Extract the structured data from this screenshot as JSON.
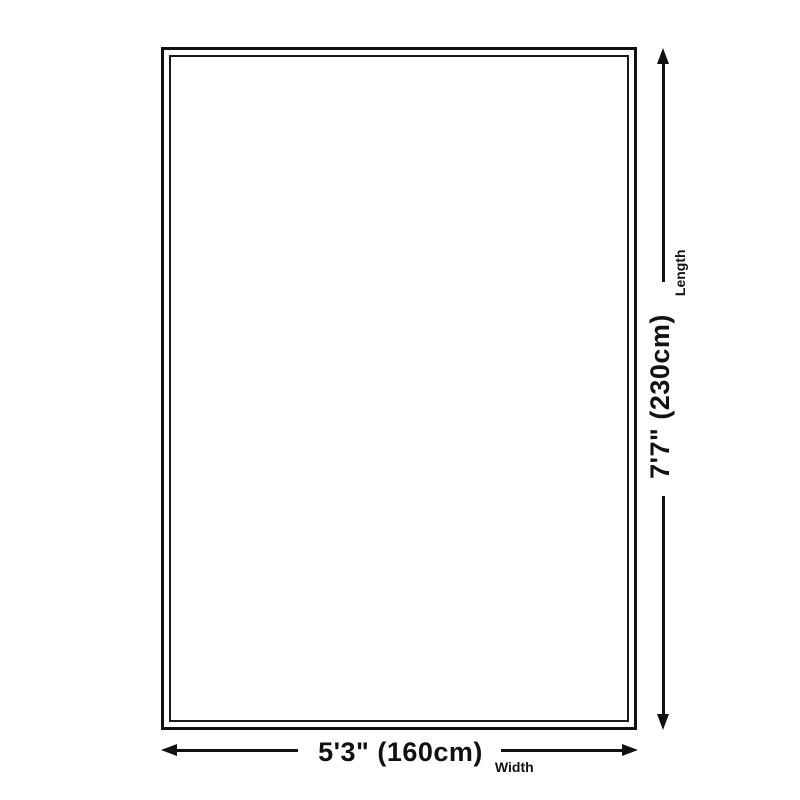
{
  "figure": {
    "kind": "rug-size-diagram",
    "background_color": "#ffffff",
    "line_color": "#111111",
    "text_color": "#111111",
    "rug": {
      "fill": "#ffffff",
      "border_color": "#111111",
      "border_style": "double"
    },
    "width": {
      "value": "5'3\" (160cm)",
      "axis": "Width"
    },
    "length": {
      "value": "7'7\" (230cm)",
      "axis": "Length"
    }
  }
}
